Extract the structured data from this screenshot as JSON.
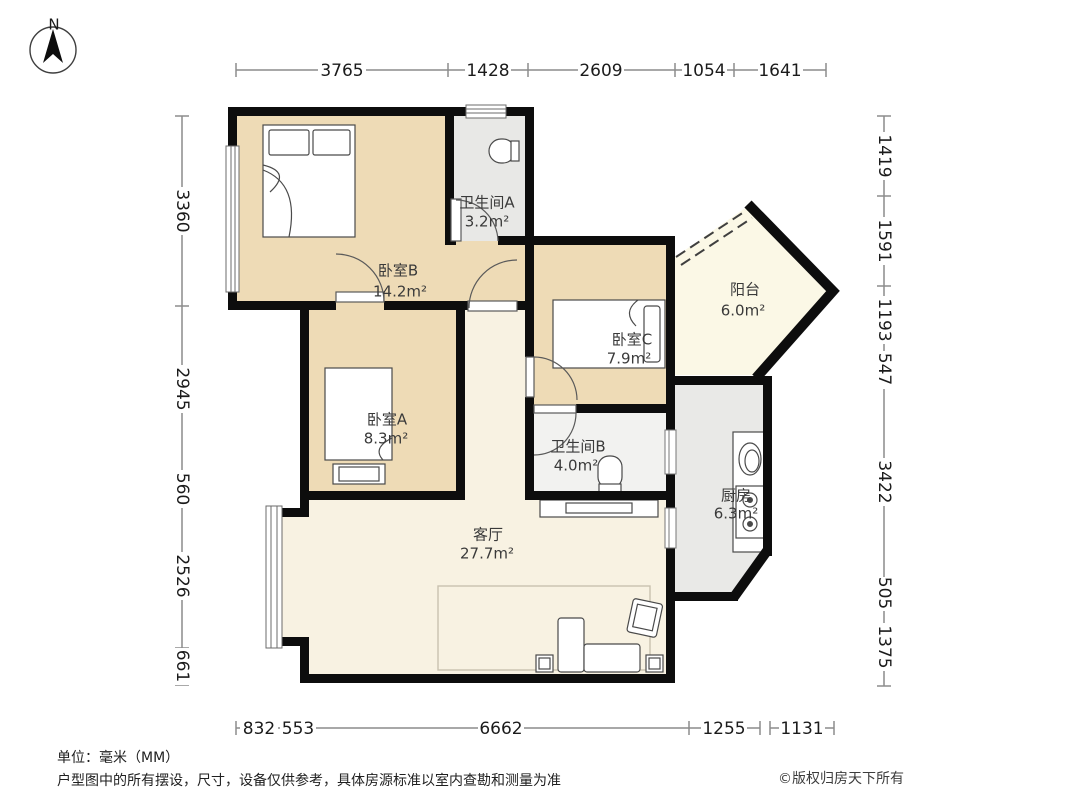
{
  "compass": {
    "label": "N"
  },
  "dimensions": {
    "top": [
      "3765",
      "1428",
      "2609",
      "1054",
      "1641"
    ],
    "left": [
      "3360",
      "2945",
      "560",
      "2526",
      "661"
    ],
    "right": [
      "1419",
      "1591",
      "1193",
      "547",
      "3422",
      "505",
      "1375"
    ],
    "bottom": [
      "832",
      "553",
      "6662",
      "1255",
      "1131"
    ]
  },
  "rooms": {
    "bedroom_b": {
      "name": "卧室B",
      "area": "14.2m²"
    },
    "bath_a": {
      "name": "卫生间A",
      "area": "3.2m²"
    },
    "balcony": {
      "name": "阳台",
      "area": "6.0m²"
    },
    "bedroom_c": {
      "name": "卧室C",
      "area": "7.9m²"
    },
    "bedroom_a": {
      "name": "卧室A",
      "area": "8.3m²"
    },
    "bath_b": {
      "name": "卫生间B",
      "area": "4.0m²"
    },
    "living": {
      "name": "客厅",
      "area": "27.7m²"
    },
    "kitchen": {
      "name": "厨房",
      "area": "6.3m²"
    }
  },
  "footer": {
    "unit_note": "单位：毫米（MM）",
    "disclaimer": "户型图中的所有摆设，尺寸，设备仅供参考，具体房源标准以室内查勘和测量为准",
    "copyright": "©版权归房天下所有"
  },
  "colors": {
    "bedroom_fill": "#eedbb6",
    "living_fill": "#f8f2e2",
    "bath_a_fill": "#e8e8e6",
    "bath_b_fill": "#f2f2f0",
    "kitchen_fill": "#e9e9e7",
    "balcony_fill": "#fbf8e6",
    "wall": "#0d0d0d"
  }
}
